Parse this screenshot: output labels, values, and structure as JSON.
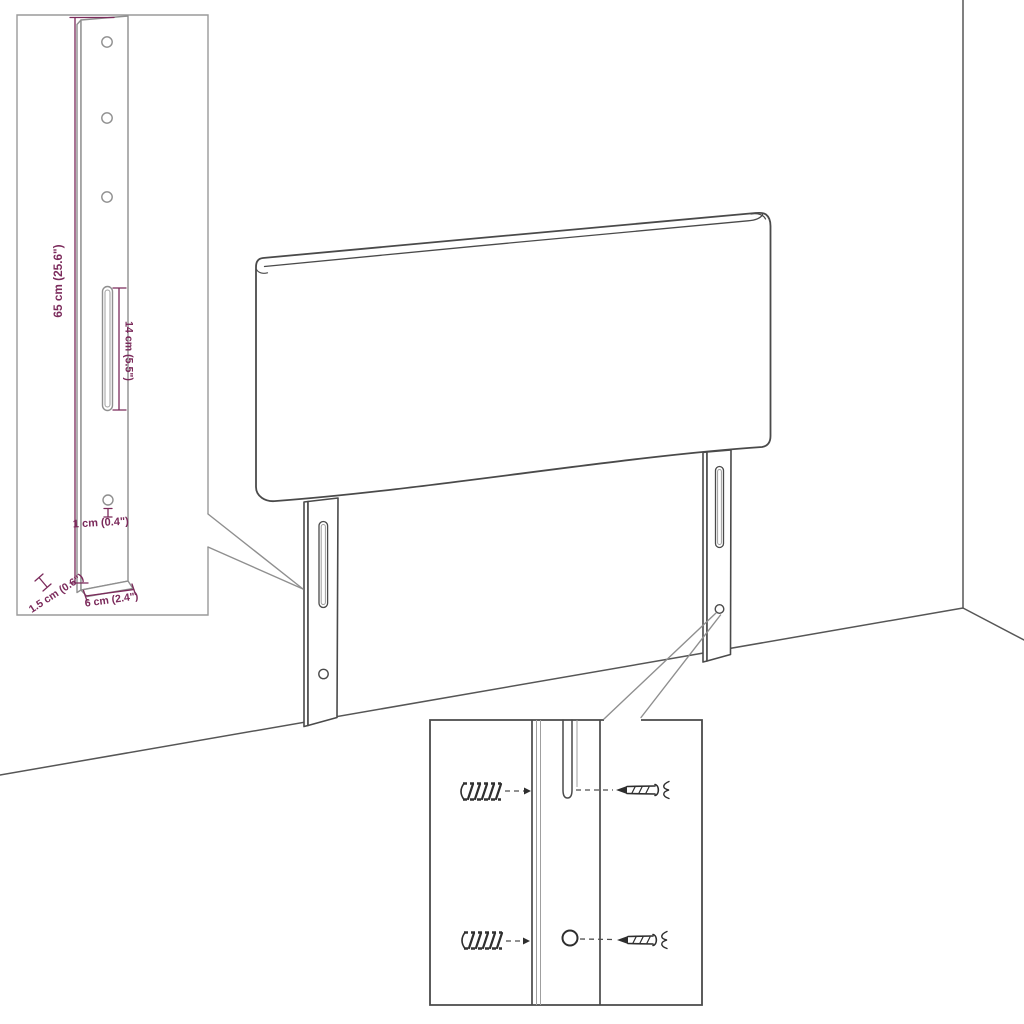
{
  "diagram": {
    "kind": "headboard assembly dimension diagram",
    "colors": {
      "background": "#ffffff",
      "dimension_text": "#7b2a5b",
      "drawing_line": "#4a4a4a",
      "detail_line": "#8f8f8f",
      "wall_line": "#565656"
    },
    "labels": {
      "leg_height": "65 cm (25.6\")",
      "slot_length": "14 cm (5.5\")",
      "hole_diameter": "1 cm (0.4\")",
      "leg_depth": "1.5 cm (0.6\")",
      "leg_width": "6 cm (2.4\")"
    },
    "parts": {
      "panel": "headboard panel",
      "legs": "two slotted mounting legs",
      "insets": [
        "leg dimension detail",
        "wall plug and screw detail"
      ]
    }
  }
}
